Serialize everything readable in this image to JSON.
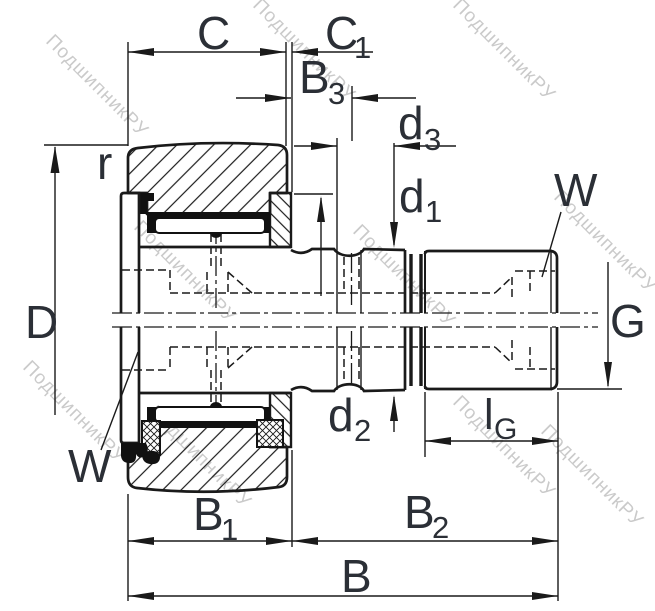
{
  "drawing": {
    "kind": "bearing-dimension-drawing",
    "description": "Sectioned technical drawing of a stud-type track roller (cam follower) bearing with dimension callouts"
  },
  "labels": {
    "c": "C",
    "c1": {
      "base": "C",
      "sub": "1"
    },
    "b3": {
      "base": "B",
      "sub": "3"
    },
    "d3": {
      "base": "d",
      "sub": "3"
    },
    "d1": {
      "base": "d",
      "sub": "1"
    },
    "d2": {
      "base": "d",
      "sub": "2"
    },
    "lg": {
      "base": "l",
      "sub": "G"
    },
    "b1": {
      "base": "B",
      "sub": "1"
    },
    "b2": {
      "base": "B",
      "sub": "2"
    },
    "b": "B",
    "w_top": "W",
    "w_bottom": "W",
    "r": "r",
    "D": "D",
    "G": "G"
  },
  "watermark": {
    "text": "ПодшипникРУ"
  },
  "colors": {
    "line": "#1a1a1a",
    "label": "#2b2f36",
    "watermark": "#bdbdbd",
    "background": "#ffffff"
  }
}
